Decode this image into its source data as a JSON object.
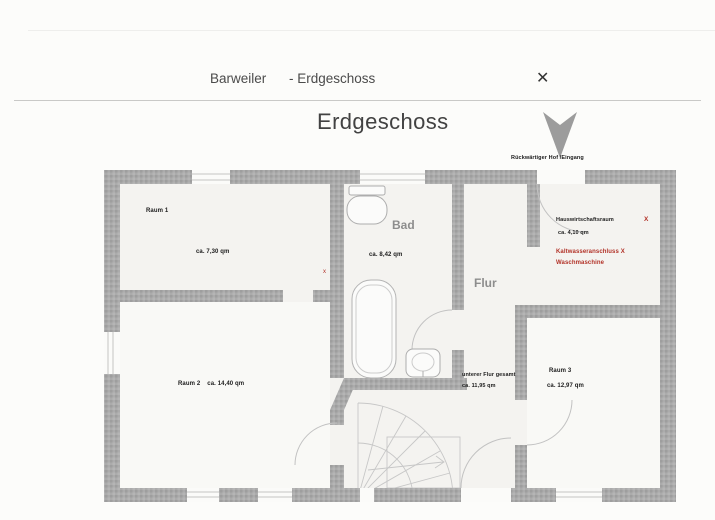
{
  "header": {
    "location": "Barweiler",
    "floor": "- Erdgeschoss",
    "close_glyph": "✕"
  },
  "plan": {
    "heading": "Erdgeschoss",
    "entrance_label": "Rückwärtiger Hof /Eingang",
    "rooms": {
      "raum1": {
        "name": "Raum 1",
        "area": "ca. 7,30 qm"
      },
      "raum2": {
        "name": "Raum 2",
        "area": "ca. 14,40 qm"
      },
      "raum3": {
        "name": "Raum 3",
        "area": "ca. 12,97 qm"
      },
      "bad": {
        "name": "Bad",
        "area": "ca. 8,42 qm"
      },
      "flur": {
        "name": "Flur"
      },
      "hauswirtschaft": {
        "name": "Hauswirtschaftsraum",
        "area": "ca. 4,10 qm"
      },
      "unterer_flur": {
        "name": "unterer Flur gesamt",
        "area": "ca. 11,95 qm"
      }
    },
    "annotations": {
      "kaltwasseranschluss": "Kaltwasseranschluss  X",
      "waschmaschine": "Waschmaschine",
      "x_marker_hauswirtschaft": "X",
      "x_marker_raum1": "x"
    },
    "colors": {
      "wall_gray": "#a8a8a8",
      "annotation_red": "#b23228",
      "room_label_gray": "#8d8d8d"
    }
  }
}
